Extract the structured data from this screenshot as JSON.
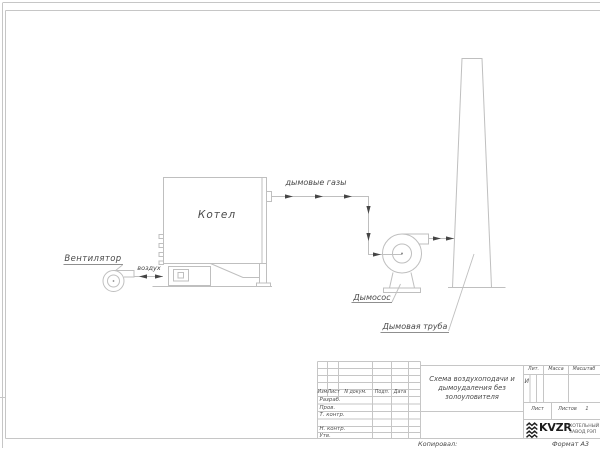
{
  "colors": {
    "cad_line": "#bfbfbf",
    "frame_line": "#c6c6c6",
    "text": "#4a4a4a",
    "arrow": "#454545",
    "logo": "#1c1c1c"
  },
  "diagram": {
    "fan_label": "Вентилятор",
    "air_flow_label": "воздух",
    "boiler_label": "Котел",
    "flue_gas_label": "дымовые газы",
    "exhauster_label": "Дымосос",
    "chimney_label": "Дымовая труба"
  },
  "title_block": {
    "header": {
      "rev": "Изм.",
      "sheet": "Лист",
      "doc_no": "N докум.",
      "sign": "Подп.",
      "date": "Дата"
    },
    "signature_rows": {
      "developed": "Разраб.",
      "checked": "Пров.",
      "tech_control": "Т. контр.",
      "norm_control": "Н. контр.",
      "approved": "Утв."
    },
    "doc_title_line1": "Схема воздухоподачи и",
    "doc_title_line2": "дымоудаления без",
    "doc_title_line3": "золоуловителя",
    "lit_header": "Лит.",
    "mass_header": "Масса",
    "scale_header": "Масштаб",
    "lit_value": "И",
    "sheet_label": "Лист",
    "sheets_label": "Листов",
    "sheets_value": "1",
    "company_logo_text": "KVZR",
    "company_name_line1": "КОТЕЛЬНЫЙ",
    "company_name_line2": "ЗАВОД РЭП"
  },
  "footer": {
    "copied_label": "Копировал:",
    "format_label": "Формат А3"
  }
}
